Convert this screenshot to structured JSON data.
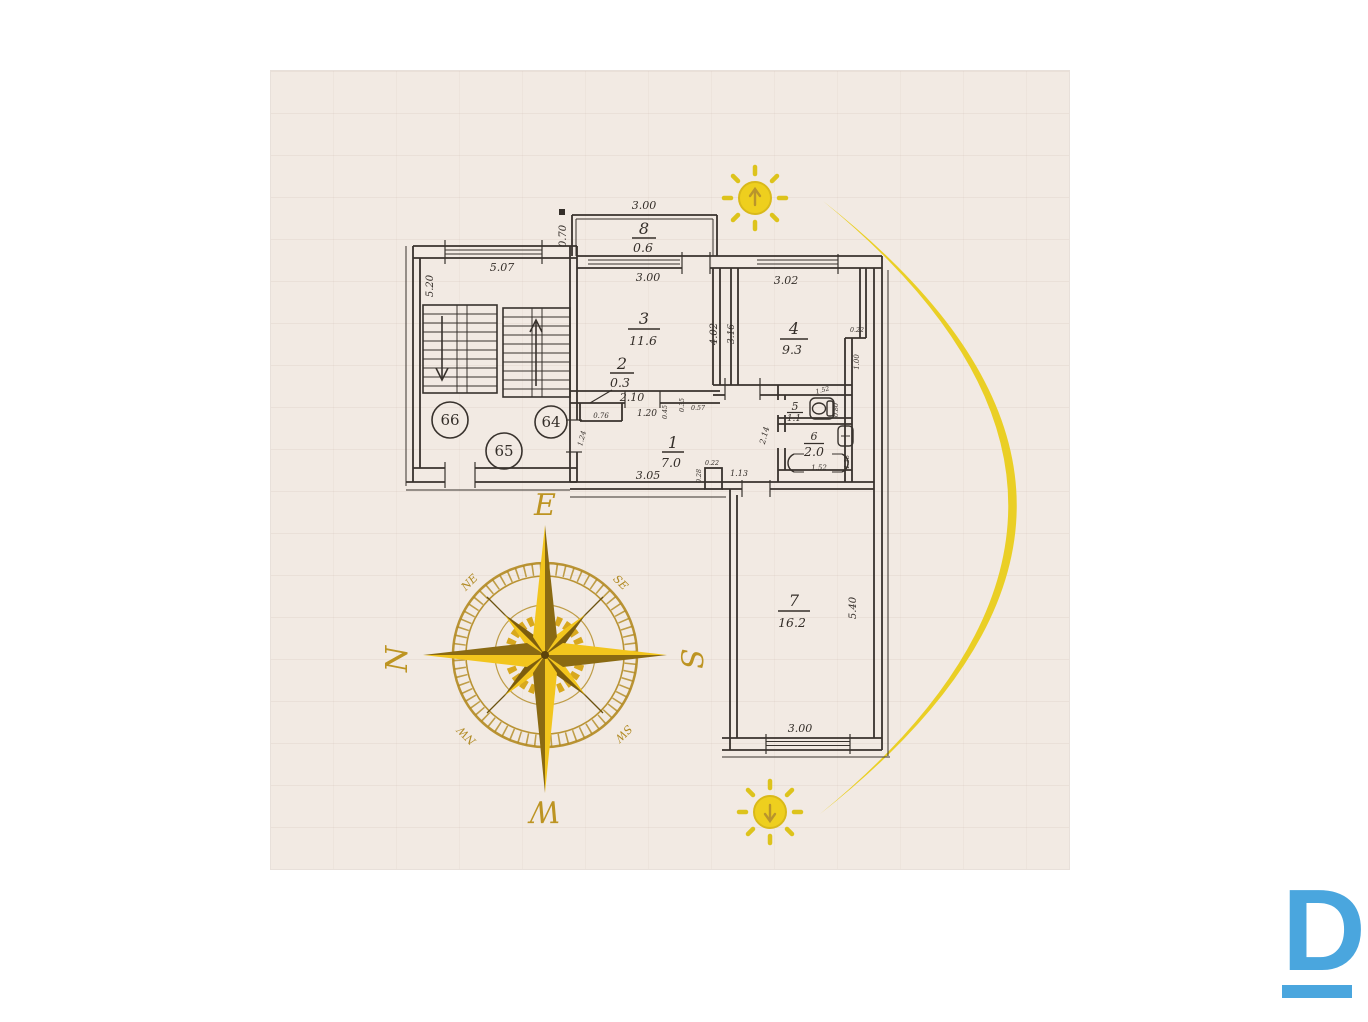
{
  "plan": {
    "rooms": [
      {
        "number": "1",
        "area": "7.0"
      },
      {
        "number": "2",
        "area": "0.3"
      },
      {
        "number": "3",
        "area": "11.6"
      },
      {
        "number": "4",
        "area": "9.3"
      },
      {
        "number": "5",
        "area": "1.1"
      },
      {
        "number": "6",
        "area": "2.0"
      },
      {
        "number": "7",
        "area": "16.2"
      },
      {
        "number": "8",
        "area": "0.6"
      }
    ],
    "apartment_units": [
      "66",
      "64",
      "65"
    ],
    "dims": {
      "balcony_top": "3.00",
      "balcony_side": "0.70",
      "room3_top": "3.00",
      "room4_top": "3.02",
      "stair_top": "5.07",
      "stair_side": "5.20",
      "shaft_left": "4.02",
      "shaft_right": "3.16",
      "room4_notch": "0.22",
      "room4_duct": "1.00",
      "closet_top": "2.10",
      "closet_inner": "0.76",
      "hall_top_a": "1.20",
      "hall_top_b": "0.45",
      "hall_wall_a": "0.35",
      "hall_wall_b": "0.57",
      "hall_left": "1.24",
      "hall_bottom": "3.05",
      "corridor_side": "2.14",
      "wc_top": "1.52",
      "wc_fixture": "0.80",
      "bath_bottom": "1.52",
      "bath_side": "1.38",
      "door_notch_a": "0.22",
      "door_notch_b": "0.28",
      "door_width": "1.13",
      "room7_side": "5.40",
      "room7_bottom": "3.00"
    }
  },
  "compass": {
    "e": "E",
    "n": "N",
    "s": "S",
    "w": "W",
    "ne": "NE",
    "se": "SE",
    "sw": "SW",
    "nw": "NW"
  },
  "icons": {
    "sunrise-sun-icon": "sun with up arrow",
    "sunset-sun-icon": "sun with down arrow",
    "compass-rose-icon": "gold 8-point compass rose",
    "toilet-icon": "toilet plan symbol",
    "bathtub-icon": "bathtub plan symbol",
    "sink-icon": "sink plan symbol"
  },
  "logo": {
    "letter": "D"
  },
  "colors": {
    "paper": "#f2eae3",
    "ink": "#342e29",
    "accent_yellow": "#e9ce1a",
    "compass_gold": "#bd9422",
    "logo_blue": "#4aa6de"
  }
}
